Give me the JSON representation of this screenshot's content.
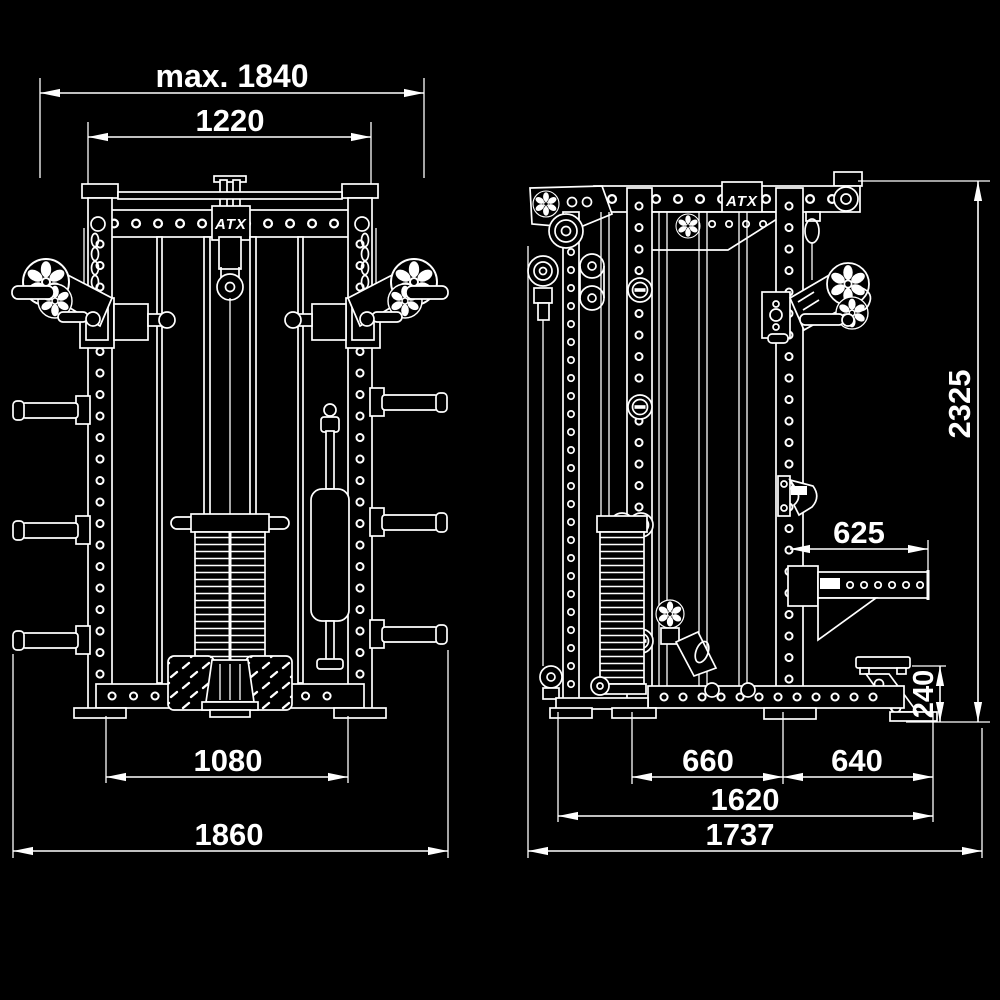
{
  "colors": {
    "background": "#000000",
    "line": "#ffffff"
  },
  "front_view": {
    "logo": "ATX",
    "dimensions": {
      "max_width": "max. 1840",
      "top_width": "1220",
      "base_inner_width": "1080",
      "overall_width": "1860"
    }
  },
  "side_view": {
    "logo": "ATX",
    "dimensions": {
      "overall_height": "2325",
      "spotter_arm_length": "625",
      "rear_foot_height": "240",
      "front_base_depth": "660",
      "rear_base_depth": "640",
      "inner_depth": "1620",
      "overall_depth": "1737"
    }
  }
}
